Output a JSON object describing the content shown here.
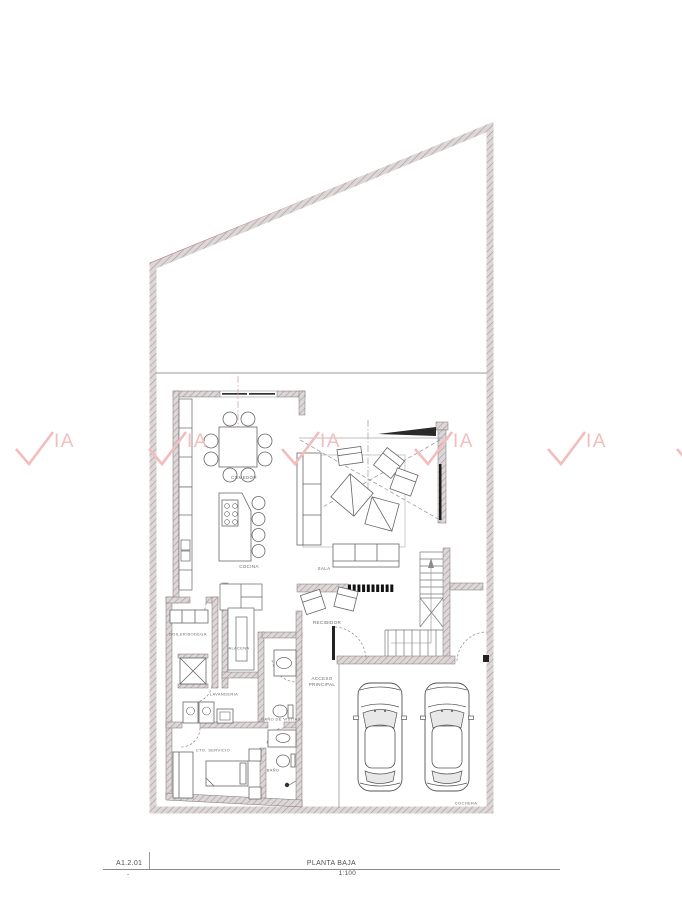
{
  "page": {
    "width": 682,
    "height": 900,
    "background": "#ffffff"
  },
  "title_block": {
    "sheet_code": "A1.2.01",
    "sheet_note": "-",
    "drawing_title": "PLANTA BAJA",
    "scale": "1:100"
  },
  "watermark": {
    "text": "IA",
    "symbol": "check-v",
    "color": "#f3bdbd"
  },
  "room_labels": {
    "comedor": "COMEDOR",
    "cocina": "COCINA",
    "sala": "SALA",
    "recibidor": "RECIBIDOR",
    "acceso_principal": "ACCESO\nPRINCIPAL",
    "bodega": "BOILER/BODEGA",
    "alacena": "ALACENA",
    "lavanderia": "LAVANDERIA",
    "bano_visitas": "BAÑO DE VISITAS",
    "cto_servicio": "CTO. SERVICIO",
    "bano": "BAÑO",
    "cochera": "COCHERA"
  },
  "colors": {
    "wall_fill": "#ddd7d7",
    "wall_hatch": "#a89e9e",
    "boundary_red": "#c08585",
    "drawing_line": "#666666",
    "label_text": "#6b6b6b",
    "watermark": "#f3bdbd"
  }
}
